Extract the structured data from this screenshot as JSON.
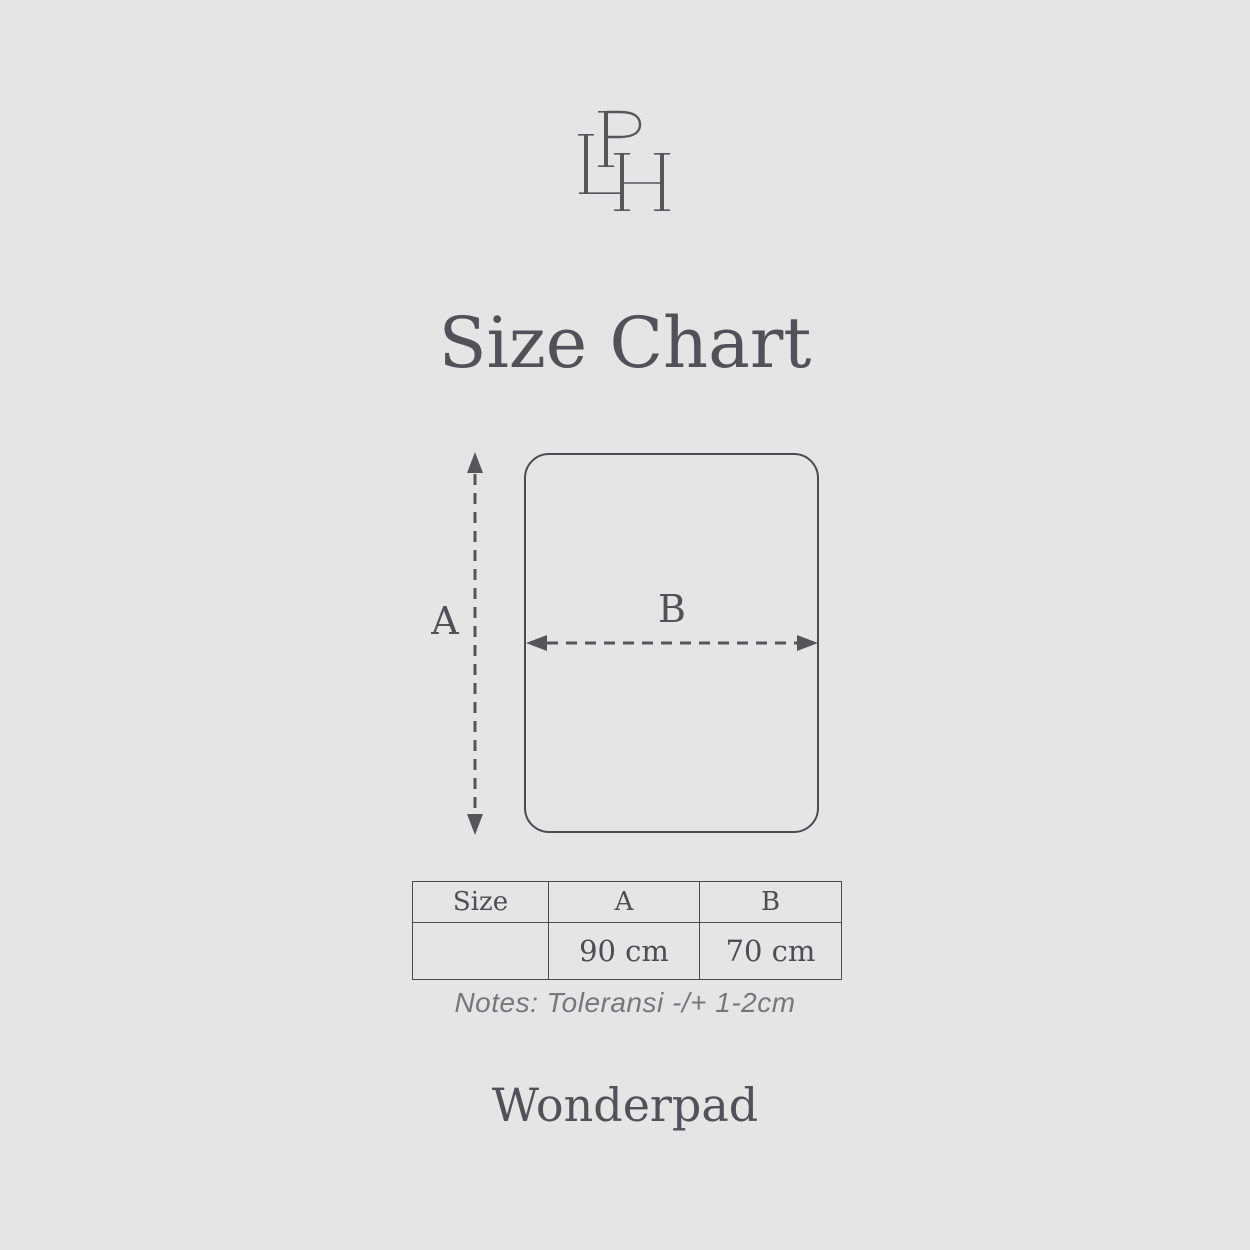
{
  "brand": {
    "monogram_letters": "LPH"
  },
  "title": "Size Chart",
  "diagram": {
    "label_a": "A",
    "label_b": "B"
  },
  "size_table": {
    "headers": [
      "Size",
      "A",
      "B"
    ],
    "row": [
      "",
      "90 cm",
      "70 cm"
    ]
  },
  "notes": "Notes: Toleransi -/+ 1-2cm",
  "product_name": "Wonderpad",
  "colors": {
    "background": "#e5e5e6",
    "ink": "#54545a",
    "table_border": "#4b4b50",
    "note_gray": "#77777b"
  },
  "chart_data": {
    "type": "table",
    "title": "Size Chart",
    "columns": [
      "Size",
      "A",
      "B"
    ],
    "rows": [
      [
        "",
        "90 cm",
        "70 cm"
      ]
    ],
    "dimensions": {
      "A": "90 cm",
      "B": "70 cm"
    },
    "note": "Notes: Toleransi -/+ 1-2cm"
  }
}
